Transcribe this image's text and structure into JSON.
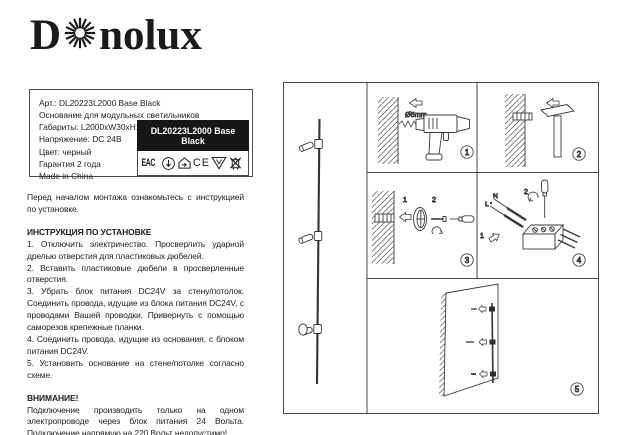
{
  "logo": {
    "d": "D",
    "rest": "nolux"
  },
  "product_info": {
    "lines": [
      "Арт.: DL20223L2000 Base Black",
      "Основание для модульных светильников",
      "Габариты: L2000xW30xH130 мм",
      "Напряжение: DC 24В",
      "Цвет: черный",
      "Гарантия 2 года",
      "Made in China"
    ],
    "model_label": "DL20223L2000 Base Black",
    "eac_text": "EAC",
    "ce_text": "CE",
    "triangle_letter": "V"
  },
  "intro_text": "Перед началом монтажа ознакомьтесь с инструкцией по установке.",
  "instructions": {
    "heading": "ИНСТРУКЦИЯ ПО УСТАНОВКЕ",
    "steps": [
      "1. Отключить электричество. Просверлить ударной дрелью отверстия для пластиковых дюбелей.",
      "2. Вставить пластиковые дюбели в просверленные отверстия.",
      "3. Убрать блок питания DC24V за стену/потолок. Соединить провода, идущие из блока питания DC24V, с проводами Вашей проводки. Привернуть с помощью саморезов крепежные планки.",
      "4. Соединить провода, идущие из основания, с блоком питания DC24V.",
      "5. Установить основание на стене/потолке согласно схеме."
    ]
  },
  "warning": {
    "heading": "ВНИМАНИЕ!",
    "text": "Подключение производить только на одном электропроводе через блок питания 24 Вольта. Подключение напрямую на 220 Вольт недопустимо!"
  },
  "diagrams": {
    "step1": {
      "badge": "1",
      "drill_label": "Ø6mm"
    },
    "step2": {
      "badge": "2"
    },
    "step3": {
      "badge": "3",
      "mark1": "1",
      "mark2": "2"
    },
    "step4": {
      "badge": "4",
      "mark1": "1",
      "mark2": "2",
      "wire_l": "L",
      "wire_n": "N"
    },
    "step5": {
      "badge": "5"
    }
  },
  "colors": {
    "ink": "#222222",
    "label_bg": "#161616",
    "border": "#4c4c4c"
  }
}
